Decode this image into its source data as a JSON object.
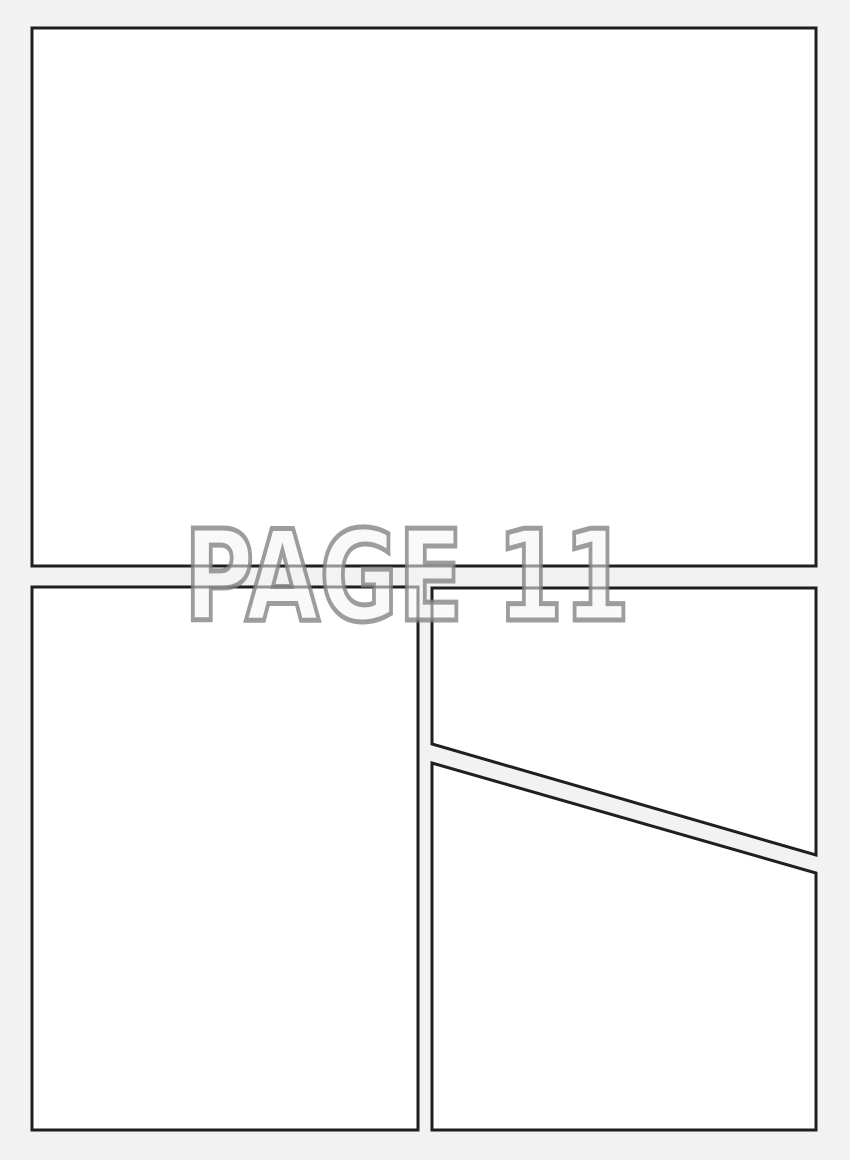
{
  "watermark": {
    "text": "PAGE 11",
    "fill_color": "#f4f4f4",
    "outline_color": "#828282"
  },
  "colors": {
    "page_background": "#f2f2f2",
    "panel_fill": "#ffffff",
    "panel_border": "#1f1f1f"
  },
  "panels": [
    {
      "id": "panel-1",
      "position": "top-full-width"
    },
    {
      "id": "panel-2",
      "position": "bottom-left"
    },
    {
      "id": "panel-3",
      "position": "top-right-above-diagonal"
    },
    {
      "id": "panel-4",
      "position": "bottom-right-below-diagonal"
    }
  ]
}
